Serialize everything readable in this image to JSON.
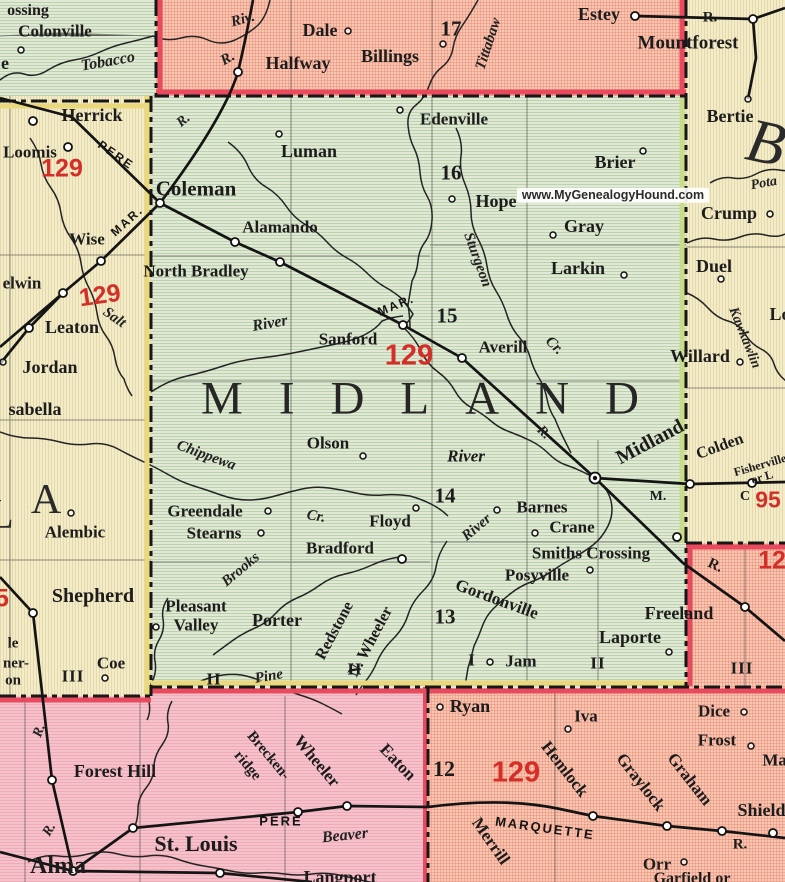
{
  "map": {
    "watermark": "www.MyGenealogyHound.com",
    "county_name": "MIDLAND",
    "colors": {
      "midland_fill": "#e0e9d3",
      "isabella_fill": "#f3ecc9",
      "gladwin_fill": "#f7c7b2",
      "gratiot_fill": "#f5c2cb",
      "route_red": "#d32f28",
      "border_red": "#e84b5e",
      "border_yellow": "#ead97c",
      "border_olive": "#c8dc8a",
      "ink": "#1c1c1c"
    },
    "labels": [
      {
        "t": "ossing",
        "x": 28,
        "y": 11,
        "c": "t"
      },
      {
        "t": "Colonville",
        "x": 55,
        "y": 31,
        "c": "t",
        "s": 17
      },
      {
        "t": "e",
        "x": 5,
        "y": 63,
        "c": "t",
        "s": 18
      },
      {
        "t": "Tobacco",
        "x": 108,
        "y": 62,
        "c": "rv",
        "s": 16,
        "r": -10
      },
      {
        "t": "Riv.",
        "x": 243,
        "y": 20,
        "c": "rv",
        "r": -15
      },
      {
        "t": "R.",
        "x": 228,
        "y": 59,
        "c": "rv",
        "r": -30
      },
      {
        "t": "Dale",
        "x": 320,
        "y": 30,
        "c": "t",
        "s": 18
      },
      {
        "t": "Halfway",
        "x": 298,
        "y": 63,
        "c": "t",
        "s": 18
      },
      {
        "t": "Billings",
        "x": 390,
        "y": 56,
        "c": "t",
        "s": 18
      },
      {
        "t": "17",
        "x": 451,
        "y": 29,
        "c": "num"
      },
      {
        "t": "Tittabaw",
        "x": 489,
        "y": 44,
        "c": "rv",
        "r": -72
      },
      {
        "t": "Estey",
        "x": 599,
        "y": 14,
        "c": "t",
        "s": 18
      },
      {
        "t": "Mountforest",
        "x": 688,
        "y": 43,
        "c": "t",
        "s": 19
      },
      {
        "t": "R.",
        "x": 710,
        "y": 18,
        "c": "t",
        "s": 15
      },
      {
        "t": "Herrick",
        "x": 92,
        "y": 115,
        "c": "t",
        "s": 18
      },
      {
        "t": "Loomis",
        "x": 30,
        "y": 152,
        "c": "t",
        "s": 17
      },
      {
        "t": "129",
        "x": 62,
        "y": 169,
        "c": "red"
      },
      {
        "t": "PERE",
        "x": 116,
        "y": 155,
        "c": "rr",
        "r": 35
      },
      {
        "t": "Coleman",
        "x": 196,
        "y": 189,
        "c": "t",
        "s": 21
      },
      {
        "t": "R.",
        "x": 184,
        "y": 121,
        "c": "rv",
        "s": 14,
        "r": -40
      },
      {
        "t": "Luman",
        "x": 309,
        "y": 151,
        "c": "t",
        "s": 18
      },
      {
        "t": "Edenville",
        "x": 454,
        "y": 119,
        "c": "t",
        "s": 17
      },
      {
        "t": "16",
        "x": 451,
        "y": 173,
        "c": "num"
      },
      {
        "t": "Hope",
        "x": 496,
        "y": 201,
        "c": "t",
        "s": 18
      },
      {
        "t": "Brier",
        "x": 615,
        "y": 162,
        "c": "t",
        "s": 18
      },
      {
        "t": "Gray",
        "x": 584,
        "y": 226,
        "c": "t",
        "s": 18
      },
      {
        "t": "Larkin",
        "x": 578,
        "y": 268,
        "c": "t",
        "s": 18
      },
      {
        "t": "Bertie",
        "x": 730,
        "y": 116,
        "c": "t",
        "s": 18
      },
      {
        "t": "B",
        "x": 766,
        "y": 143,
        "c": "ctyB",
        "r": 12
      },
      {
        "t": "Pota",
        "x": 764,
        "y": 184,
        "c": "rv",
        "s": 14,
        "r": -10
      },
      {
        "t": "Crump",
        "x": 729,
        "y": 213,
        "c": "t",
        "s": 18
      },
      {
        "t": "Duel",
        "x": 714,
        "y": 266,
        "c": "t",
        "s": 18
      },
      {
        "t": "Lo",
        "x": 780,
        "y": 314,
        "c": "t",
        "s": 18
      },
      {
        "t": "Kawkawlin",
        "x": 744,
        "y": 338,
        "c": "rv",
        "s": 14,
        "r": 68
      },
      {
        "t": "Willard",
        "x": 700,
        "y": 356,
        "c": "t",
        "s": 18
      },
      {
        "t": "Alamando",
        "x": 280,
        "y": 227,
        "c": "t",
        "s": 17
      },
      {
        "t": "North Bradley",
        "x": 196,
        "y": 271,
        "c": "t",
        "s": 17
      },
      {
        "t": "Wise",
        "x": 87,
        "y": 239,
        "c": "t",
        "s": 17
      },
      {
        "t": "MAR.",
        "x": 127,
        "y": 221,
        "c": "rr",
        "r": -42
      },
      {
        "t": "elwin",
        "x": 22,
        "y": 283,
        "c": "t",
        "s": 17
      },
      {
        "t": "129",
        "x": 100,
        "y": 296,
        "c": "red",
        "r": -8
      },
      {
        "t": "Salt",
        "x": 114,
        "y": 318,
        "c": "rv",
        "r": 35
      },
      {
        "t": "Leaton",
        "x": 72,
        "y": 327,
        "c": "t",
        "s": 18
      },
      {
        "t": "Jordan",
        "x": 50,
        "y": 367,
        "c": "t",
        "s": 18
      },
      {
        "t": "sabella",
        "x": 35,
        "y": 409,
        "c": "t",
        "s": 18
      },
      {
        "t": "MAR.",
        "x": 396,
        "y": 305,
        "c": "rr",
        "r": -22
      },
      {
        "t": "15",
        "x": 447,
        "y": 316,
        "c": "num"
      },
      {
        "t": "Sanford",
        "x": 348,
        "y": 339,
        "c": "t",
        "s": 17
      },
      {
        "t": "129",
        "x": 409,
        "y": 356,
        "c": "red",
        "s": 29
      },
      {
        "t": "Averill",
        "x": 503,
        "y": 347,
        "c": "t",
        "s": 17
      },
      {
        "t": "Sturgeon",
        "x": 477,
        "y": 260,
        "c": "rv",
        "r": 70
      },
      {
        "t": "Cr.",
        "x": 554,
        "y": 346,
        "c": "rv",
        "r": 45
      },
      {
        "t": "River",
        "x": 270,
        "y": 324,
        "c": "rv",
        "s": 16,
        "r": -10
      },
      {
        "t": "MIDLAND",
        "x": 438,
        "y": 399,
        "c": "cty"
      },
      {
        "t": "Olson",
        "x": 328,
        "y": 443,
        "c": "t",
        "s": 17
      },
      {
        "t": "River",
        "x": 466,
        "y": 456,
        "c": "rvb"
      },
      {
        "t": "R.",
        "x": 543,
        "y": 433,
        "c": "rv",
        "s": 14,
        "r": 45
      },
      {
        "t": "Midland",
        "x": 650,
        "y": 442,
        "c": "city",
        "r": -28
      },
      {
        "t": "Colden",
        "x": 720,
        "y": 447,
        "c": "t",
        "s": 16,
        "r": -20
      },
      {
        "t": "Fisherville",
        "x": 760,
        "y": 465,
        "c": "t",
        "s": 12,
        "r": -16
      },
      {
        "t": "or L",
        "x": 762,
        "y": 477,
        "c": "t",
        "s": 12,
        "r": -16
      },
      {
        "t": "C",
        "x": 745,
        "y": 497,
        "c": "t",
        "s": 14
      },
      {
        "t": "95",
        "x": 768,
        "y": 500,
        "c": "red",
        "s": 23
      },
      {
        "t": "M.",
        "x": 658,
        "y": 497,
        "c": "t",
        "s": 14
      },
      {
        "t": "L",
        "x": 1,
        "y": 515,
        "c": "ctyS"
      },
      {
        "t": "A",
        "x": 46,
        "y": 500,
        "c": "ctyS"
      },
      {
        "t": "Alembic",
        "x": 75,
        "y": 532,
        "c": "t",
        "s": 17
      },
      {
        "t": "Chippewa",
        "x": 206,
        "y": 456,
        "c": "rv",
        "r": 20
      },
      {
        "t": "Greendale",
        "x": 205,
        "y": 511,
        "c": "t",
        "s": 17
      },
      {
        "t": "Stearns",
        "x": 214,
        "y": 533,
        "c": "t",
        "s": 17
      },
      {
        "t": "Cr.",
        "x": 316,
        "y": 517,
        "c": "rv",
        "r": 10
      },
      {
        "t": "Floyd",
        "x": 390,
        "y": 521,
        "c": "t",
        "s": 17
      },
      {
        "t": "Bradford",
        "x": 340,
        "y": 548,
        "c": "t",
        "s": 17
      },
      {
        "t": "Brooks",
        "x": 241,
        "y": 570,
        "c": "rv",
        "r": -40
      },
      {
        "t": "14",
        "x": 445,
        "y": 496,
        "c": "num"
      },
      {
        "t": "Barnes",
        "x": 542,
        "y": 507,
        "c": "t",
        "s": 17
      },
      {
        "t": "Crane",
        "x": 572,
        "y": 527,
        "c": "t",
        "s": 17
      },
      {
        "t": "Smiths Crossing",
        "x": 591,
        "y": 553,
        "c": "t",
        "s": 17
      },
      {
        "t": "Posyville",
        "x": 537,
        "y": 575,
        "c": "t",
        "s": 17
      },
      {
        "t": "River",
        "x": 477,
        "y": 528,
        "c": "rv",
        "r": -40
      },
      {
        "t": "Gordonville",
        "x": 497,
        "y": 599,
        "c": "t",
        "s": 17,
        "r": 20
      },
      {
        "t": "13",
        "x": 445,
        "y": 617,
        "c": "num"
      },
      {
        "t": "Redstone",
        "x": 335,
        "y": 631,
        "c": "t",
        "s": 16,
        "r": -62
      },
      {
        "t": "N. Wheeler",
        "x": 371,
        "y": 642,
        "c": "t",
        "s": 16,
        "r": -62
      },
      {
        "t": "Pine",
        "x": 269,
        "y": 677,
        "c": "rv",
        "r": -10
      },
      {
        "t": "Shepherd",
        "x": 93,
        "y": 596,
        "c": "t",
        "s": 20
      },
      {
        "t": "5",
        "x": 2,
        "y": 599,
        "c": "red"
      },
      {
        "t": "Pleasant",
        "x": 196,
        "y": 606,
        "c": "t",
        "s": 17
      },
      {
        "t": "Valley",
        "x": 196,
        "y": 625,
        "c": "t",
        "s": 17
      },
      {
        "t": "Porter",
        "x": 277,
        "y": 620,
        "c": "t",
        "s": 18
      },
      {
        "t": "le",
        "x": 13,
        "y": 644,
        "c": "t",
        "s": 15
      },
      {
        "t": "ner-",
        "x": 16,
        "y": 664,
        "c": "t",
        "s": 15
      },
      {
        "t": "on",
        "x": 13,
        "y": 681,
        "c": "t",
        "s": 15
      },
      {
        "t": "Coe",
        "x": 111,
        "y": 663,
        "c": "t",
        "s": 17
      },
      {
        "t": "III",
        "x": 73,
        "y": 676,
        "c": "rom"
      },
      {
        "t": "II",
        "x": 214,
        "y": 679,
        "c": "rom"
      },
      {
        "t": "II",
        "x": 355,
        "y": 669,
        "c": "rom"
      },
      {
        "t": "I",
        "x": 472,
        "y": 660,
        "c": "rom"
      },
      {
        "t": "Jam",
        "x": 521,
        "y": 661,
        "c": "t",
        "s": 17
      },
      {
        "t": "II",
        "x": 598,
        "y": 663,
        "c": "rom"
      },
      {
        "t": "III",
        "x": 742,
        "y": 668,
        "c": "rom"
      },
      {
        "t": "Freeland",
        "x": 679,
        "y": 613,
        "c": "t",
        "s": 18
      },
      {
        "t": "Laporte",
        "x": 630,
        "y": 637,
        "c": "t",
        "s": 18
      },
      {
        "t": "R.",
        "x": 715,
        "y": 566,
        "c": "t",
        "s": 15,
        "r": 25
      },
      {
        "t": "129",
        "x": 779,
        "y": 561,
        "c": "red"
      },
      {
        "t": "Ryan",
        "x": 470,
        "y": 706,
        "c": "t",
        "s": 18
      },
      {
        "t": "Iva",
        "x": 586,
        "y": 716,
        "c": "t",
        "s": 17
      },
      {
        "t": "Dice",
        "x": 714,
        "y": 711,
        "c": "t",
        "s": 17
      },
      {
        "t": "Frost",
        "x": 717,
        "y": 740,
        "c": "t",
        "s": 17
      },
      {
        "t": "Mal",
        "x": 777,
        "y": 760,
        "c": "t",
        "s": 17
      },
      {
        "t": "12",
        "x": 444,
        "y": 769,
        "c": "num",
        "s": 22
      },
      {
        "t": "129",
        "x": 516,
        "y": 773,
        "c": "red",
        "s": 29
      },
      {
        "t": "Hemlock",
        "x": 565,
        "y": 769,
        "c": "t",
        "s": 17,
        "r": 52
      },
      {
        "t": "Graylock",
        "x": 641,
        "y": 782,
        "c": "t",
        "s": 17,
        "r": 52
      },
      {
        "t": "Graham",
        "x": 690,
        "y": 779,
        "c": "t",
        "s": 17,
        "r": 52
      },
      {
        "t": "Shields",
        "x": 765,
        "y": 810,
        "c": "t",
        "s": 18
      },
      {
        "t": "MARQUETTE",
        "x": 545,
        "y": 828,
        "c": "rr",
        "s": 13,
        "r": 8
      },
      {
        "t": "Merrill",
        "x": 491,
        "y": 841,
        "c": "t",
        "s": 17,
        "r": 55
      },
      {
        "t": "R.",
        "x": 740,
        "y": 845,
        "c": "t",
        "s": 15
      },
      {
        "t": "Orr",
        "x": 657,
        "y": 864,
        "c": "t",
        "s": 17
      },
      {
        "t": "Garfield or",
        "x": 692,
        "y": 879,
        "c": "t",
        "s": 16
      },
      {
        "t": "Wheeler",
        "x": 317,
        "y": 761,
        "c": "t",
        "s": 17,
        "r": 50
      },
      {
        "t": "Eaton",
        "x": 398,
        "y": 762,
        "c": "t",
        "s": 17,
        "r": 46
      },
      {
        "t": "Brecken-",
        "x": 268,
        "y": 756,
        "c": "t",
        "s": 15,
        "r": 50
      },
      {
        "t": "ridge",
        "x": 247,
        "y": 766,
        "c": "t",
        "s": 15,
        "r": 50
      },
      {
        "t": "Forest Hill",
        "x": 115,
        "y": 771,
        "c": "t",
        "s": 18
      },
      {
        "t": "R.",
        "x": 40,
        "y": 731,
        "c": "rv",
        "s": 14,
        "r": -70
      },
      {
        "t": "R.",
        "x": 50,
        "y": 830,
        "c": "rv",
        "s": 14,
        "r": -60
      },
      {
        "t": "PERE",
        "x": 281,
        "y": 821,
        "c": "rr",
        "s": 13
      },
      {
        "t": "Beaver",
        "x": 345,
        "y": 836,
        "c": "rv",
        "s": 16,
        "r": -6
      },
      {
        "t": "Langport",
        "x": 340,
        "y": 877,
        "c": "t",
        "s": 18
      },
      {
        "t": "St. Louis",
        "x": 196,
        "y": 844,
        "c": "tl"
      },
      {
        "t": "Alma",
        "x": 58,
        "y": 866,
        "c": "tl",
        "s": 24
      },
      {
        "t": "www.MyGenealogyHound.com",
        "x": 613,
        "y": 195,
        "c": "wm"
      }
    ],
    "markers": [
      {
        "x": 21,
        "y": 50,
        "k": "t"
      },
      {
        "x": 348,
        "y": 31,
        "k": "t"
      },
      {
        "x": 443,
        "y": 44,
        "k": "t"
      },
      {
        "x": 635,
        "y": 16,
        "k": "s"
      },
      {
        "x": 753,
        "y": 19,
        "k": "s"
      },
      {
        "x": 748,
        "y": 99,
        "k": "t"
      },
      {
        "x": 238,
        "y": 72,
        "k": "s"
      },
      {
        "x": 33,
        "y": 121,
        "k": "s"
      },
      {
        "x": 68,
        "y": 147,
        "k": "s"
      },
      {
        "x": 279,
        "y": 134,
        "k": "t"
      },
      {
        "x": 400,
        "y": 110,
        "k": "t"
      },
      {
        "x": 160,
        "y": 203,
        "k": "s"
      },
      {
        "x": 235,
        "y": 242,
        "k": "s"
      },
      {
        "x": 280,
        "y": 262,
        "k": "s"
      },
      {
        "x": 101,
        "y": 261,
        "k": "s"
      },
      {
        "x": 63,
        "y": 293,
        "k": "s"
      },
      {
        "x": 29,
        "y": 328,
        "k": "s"
      },
      {
        "x": 3,
        "y": 362,
        "k": "t"
      },
      {
        "x": 403,
        "y": 325,
        "k": "s"
      },
      {
        "x": 462,
        "y": 358,
        "k": "s"
      },
      {
        "x": 452,
        "y": 199,
        "k": "t"
      },
      {
        "x": 643,
        "y": 151,
        "k": "t"
      },
      {
        "x": 553,
        "y": 235,
        "k": "t"
      },
      {
        "x": 624,
        "y": 275,
        "k": "t"
      },
      {
        "x": 770,
        "y": 214,
        "k": "t"
      },
      {
        "x": 721,
        "y": 279,
        "k": "t"
      },
      {
        "x": 740,
        "y": 362,
        "k": "t"
      },
      {
        "x": 363,
        "y": 456,
        "k": "t"
      },
      {
        "x": 268,
        "y": 511,
        "k": "t"
      },
      {
        "x": 261,
        "y": 533,
        "k": "t"
      },
      {
        "x": 416,
        "y": 508,
        "k": "t"
      },
      {
        "x": 402,
        "y": 559,
        "k": "s"
      },
      {
        "x": 497,
        "y": 510,
        "k": "t"
      },
      {
        "x": 535,
        "y": 533,
        "k": "t"
      },
      {
        "x": 590,
        "y": 570,
        "k": "t"
      },
      {
        "x": 677,
        "y": 537,
        "k": "s"
      },
      {
        "x": 595,
        "y": 478,
        "k": "c"
      },
      {
        "x": 690,
        "y": 484,
        "k": "s"
      },
      {
        "x": 752,
        "y": 483,
        "k": "s"
      },
      {
        "x": 745,
        "y": 607,
        "k": "s"
      },
      {
        "x": 669,
        "y": 652,
        "k": "t"
      },
      {
        "x": 490,
        "y": 662,
        "k": "t"
      },
      {
        "x": 105,
        "y": 678,
        "k": "t"
      },
      {
        "x": 156,
        "y": 627,
        "k": "t"
      },
      {
        "x": 71,
        "y": 513,
        "k": "t"
      },
      {
        "x": 33,
        "y": 613,
        "k": "s"
      },
      {
        "x": 52,
        "y": 780,
        "k": "s"
      },
      {
        "x": 133,
        "y": 828,
        "k": "s"
      },
      {
        "x": 298,
        "y": 812,
        "k": "s"
      },
      {
        "x": 347,
        "y": 806,
        "k": "s"
      },
      {
        "x": 220,
        "y": 873,
        "k": "s"
      },
      {
        "x": 73,
        "y": 871,
        "k": "s"
      },
      {
        "x": 593,
        "y": 816,
        "k": "s"
      },
      {
        "x": 667,
        "y": 826,
        "k": "s"
      },
      {
        "x": 722,
        "y": 831,
        "k": "s"
      },
      {
        "x": 773,
        "y": 833,
        "k": "s"
      },
      {
        "x": 440,
        "y": 707,
        "k": "t"
      },
      {
        "x": 568,
        "y": 729,
        "k": "t"
      },
      {
        "x": 744,
        "y": 712,
        "k": "t"
      },
      {
        "x": 751,
        "y": 746,
        "k": "t"
      },
      {
        "x": 684,
        "y": 862,
        "k": "t"
      }
    ]
  }
}
